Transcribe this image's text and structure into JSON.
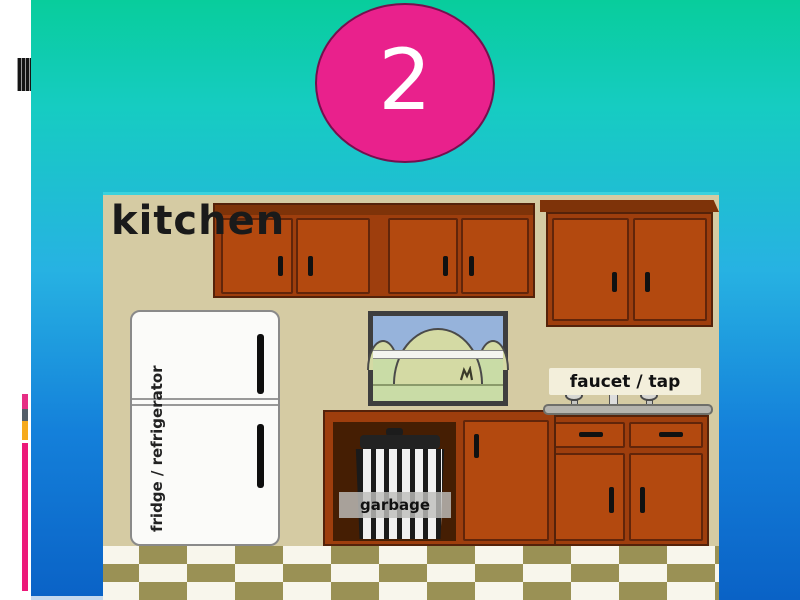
{
  "slide": {
    "badge": "2",
    "colors": {
      "badge_fill": "#E9218C",
      "gradient_top": "#08CD9C",
      "gradient_middle": "#27B2E2",
      "gradient_bottom": "#0A62C6",
      "accent_pink": "#EC1879",
      "accent_orange": "#F6AA1C",
      "accent_slate": "#555E68",
      "left_margin": "#FFFFFF"
    }
  },
  "kitchen": {
    "title": "kitchen",
    "fridge_label": "fridge / refrigerator",
    "faucet_label": "faucet / tap",
    "garbage_label": "garbage",
    "colors": {
      "wall": "#D5CBA3",
      "cabinet_brown": "#B3490F",
      "cabinet_outline": "#54220A",
      "floor_olive": "#9A9155",
      "floor_white": "#F8F6EC",
      "window_sky": "#96B3DB",
      "window_grass": "#C9DCA6"
    }
  }
}
